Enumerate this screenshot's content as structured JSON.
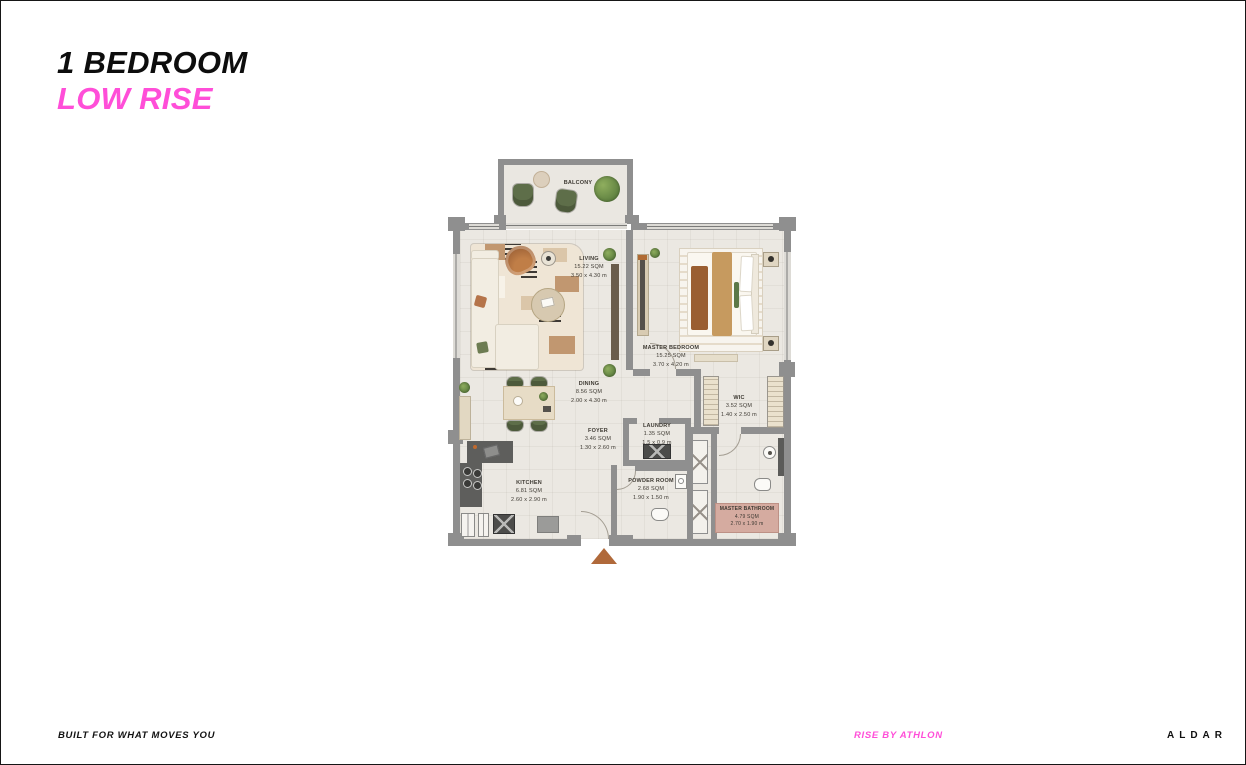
{
  "header": {
    "title_line1": "1 BEDROOM",
    "title_line2": "LOW RISE"
  },
  "footer": {
    "tagline": "BUILT FOR WHAT MOVES YOU",
    "brand_sub": "RISE BY ATHLON",
    "brand": "ALDAR"
  },
  "colors": {
    "accent_pink": "#FF4ED8",
    "wall_gray": "#8F8F8F",
    "floor_beige": "#EBE8E2",
    "entry_marker_orange": "#B0693A",
    "bath_mat_pink": "#D5ABA0"
  },
  "floorplan": {
    "balcony": {
      "name": "BALCONY"
    },
    "rooms": [
      {
        "id": "living",
        "name": "LIVING",
        "area": "15.22 SQM",
        "dims": "3.50 x 4.30 m"
      },
      {
        "id": "master-bedroom",
        "name": "MASTER BEDROOM",
        "area": "15.25 SQM",
        "dims": "3.70 x 4.20 m"
      },
      {
        "id": "dining",
        "name": "DINING",
        "area": "8.56 SQM",
        "dims": "2.00 x 4.30 m"
      },
      {
        "id": "wic",
        "name": "WIC",
        "area": "3.52 SQM",
        "dims": "1.40 x 2.50 m"
      },
      {
        "id": "foyer",
        "name": "FOYER",
        "area": "3.46 SQM",
        "dims": "1.30 x 2.60 m"
      },
      {
        "id": "laundry",
        "name": "LAUNDRY",
        "area": "1.35 SQM",
        "dims": "1.5 x 0.9 m"
      },
      {
        "id": "kitchen",
        "name": "KITCHEN",
        "area": "6.81 SQM",
        "dims": "2.60 x 2.90 m"
      },
      {
        "id": "powder-room",
        "name": "POWDER ROOM",
        "area": "2.68 SQM",
        "dims": "1.90 x 1.50 m"
      },
      {
        "id": "master-bathroom",
        "name": "MASTER BATHROOM",
        "area": "4.79 SQM",
        "dims": "2.70 x 1.90 m"
      }
    ]
  }
}
